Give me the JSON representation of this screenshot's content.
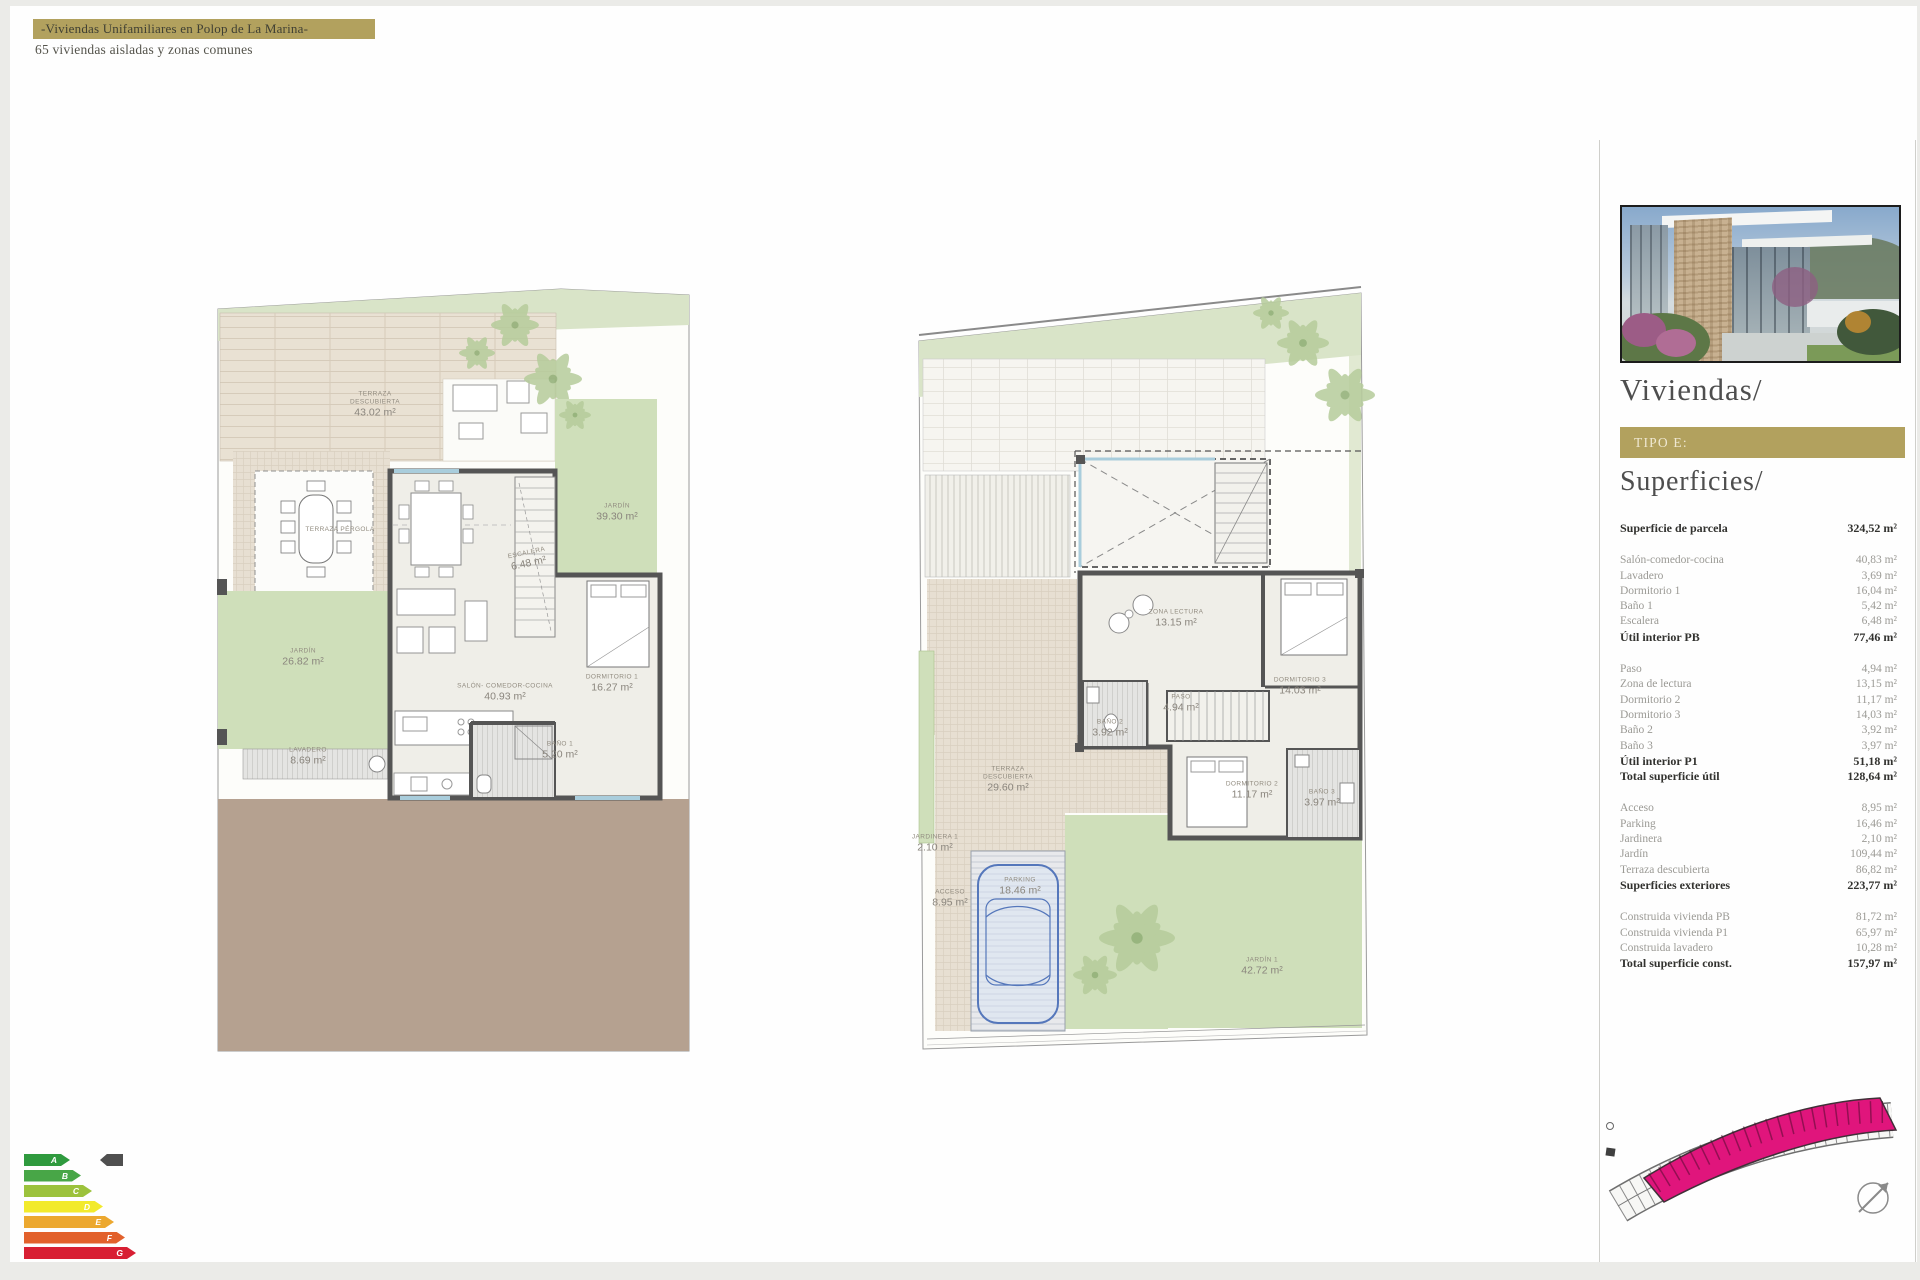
{
  "header": {
    "title": "-Viviendas Unifamiliares en Polop de La Marina-",
    "subtitle": "65 viviendas aisladas y zonas comunes"
  },
  "colors": {
    "gold": "#b2a15e",
    "siteplan_highlight": "#e0157c",
    "garden_green": "#cfdfba",
    "terrace_beige": "#e9e1d3",
    "soil_brown": "#b5a190"
  },
  "sidebar": {
    "title": "Viviendas/",
    "type_label": "TIPO E:",
    "section_title": "Superficies/",
    "photo_alt": "villa-exterior-render",
    "table": {
      "groups": [
        {
          "rows": [
            {
              "label": "Superficie de parcela",
              "value": "324,52 m²",
              "bold": true
            }
          ]
        },
        {
          "rows": [
            {
              "label": "Salón-comedor-cocina",
              "value": "40,83 m²",
              "bold": false
            },
            {
              "label": "Lavadero",
              "value": "3,69 m²",
              "bold": false
            },
            {
              "label": "Dormitorio 1",
              "value": "16,04 m²",
              "bold": false
            },
            {
              "label": "Baño 1",
              "value": "5,42 m²",
              "bold": false
            },
            {
              "label": "Escalera",
              "value": "6,48 m²",
              "bold": false
            },
            {
              "label": "Útil interior PB",
              "value": "77,46 m²",
              "bold": true
            }
          ]
        },
        {
          "rows": [
            {
              "label": "Paso",
              "value": "4,94 m²",
              "bold": false
            },
            {
              "label": "Zona de lectura",
              "value": "13,15 m²",
              "bold": false
            },
            {
              "label": "Dormitorio 2",
              "value": "11,17 m²",
              "bold": false
            },
            {
              "label": "Dormitorio 3",
              "value": "14,03 m²",
              "bold": false
            },
            {
              "label": "Baño 2",
              "value": "3,92 m²",
              "bold": false
            },
            {
              "label": "Baño 3",
              "value": "3,97 m²",
              "bold": false
            },
            {
              "label": "Útil interior P1",
              "value": "51,18 m²",
              "bold": true
            },
            {
              "label": "Total superficie útil",
              "value": "128,64 m²",
              "bold": true
            }
          ]
        },
        {
          "rows": [
            {
              "label": "Acceso",
              "value": "8,95 m²",
              "bold": false
            },
            {
              "label": "Parking",
              "value": "16,46 m²",
              "bold": false
            },
            {
              "label": "Jardinera",
              "value": "2,10 m²",
              "bold": false
            },
            {
              "label": "Jardín",
              "value": "109,44 m²",
              "bold": false
            },
            {
              "label": "Terraza descubierta",
              "value": "86,82 m²",
              "bold": false
            },
            {
              "label": "Superficies exteriores",
              "value": "223,77 m²",
              "bold": true
            }
          ]
        },
        {
          "rows": [
            {
              "label": "Construida vivienda PB",
              "value": "81,72 m²",
              "bold": false
            },
            {
              "label": "Construida vivienda P1",
              "value": "65,97 m²",
              "bold": false
            },
            {
              "label": "Construida lavadero",
              "value": "10,28 m²",
              "bold": false
            },
            {
              "label": "Total superficie const.",
              "value": "157,97 m²",
              "bold": true
            }
          ]
        }
      ]
    }
  },
  "plans": {
    "left": {
      "terraza": {
        "l1": "TERRAZA",
        "l2": "DESCUBIERTA",
        "a": "43.02 m²"
      },
      "pergola": {
        "l1": "TERRAZA PÉRGOLA",
        "a": ""
      },
      "jardin_dcha": {
        "l1": "JARDÍN",
        "a": "39.30 m²"
      },
      "jardin_izq": {
        "l1": "JARDÍN",
        "a": "26.82 m²"
      },
      "lavadero": {
        "l1": "LAVADERO",
        "a": "8.69 m²"
      },
      "escalera": {
        "l1": "ESCALERA",
        "a": "6.48 m²"
      },
      "salon": {
        "l1": "SALÓN- COMEDOR-COCINA",
        "a": "40.93 m²"
      },
      "dorm1": {
        "l1": "DORMITORIO 1",
        "a": "16.27 m²"
      },
      "bano1": {
        "l1": "BAÑO 1",
        "a": "5.20 m²"
      }
    },
    "right": {
      "zona": {
        "l1": "ZONA LECTURA",
        "a": "13.15 m²"
      },
      "paso": {
        "l1": "PASO",
        "a": "4.94 m²"
      },
      "dorm3": {
        "l1": "DORMITORIO 3",
        "a": "14.03 m²"
      },
      "bano2": {
        "l1": "BAÑO 2",
        "a": "3.92 m²"
      },
      "dorm2": {
        "l1": "DORMITORIO 2",
        "a": "11.17 m²"
      },
      "bano3": {
        "l1": "BAÑO 3",
        "a": "3.97 m²"
      },
      "terraza": {
        "l1": "TERRAZA",
        "l2": "DESCUBIERTA",
        "a": "29.60 m²"
      },
      "jardinera": {
        "l1": "JARDINERA 1",
        "a": "2.10 m²"
      },
      "acceso": {
        "l1": "ACCESO",
        "a": "8.95 m²"
      },
      "parking": {
        "l1": "PARKING",
        "a": "18.46 m²"
      },
      "jardin1": {
        "l1": "JARDÍN 1",
        "a": "42.72 m²"
      }
    }
  },
  "energy": {
    "grades": [
      {
        "letter": "A",
        "color": "#2f9a3e"
      },
      {
        "letter": "B",
        "color": "#48a647"
      },
      {
        "letter": "C",
        "color": "#9cc23c"
      },
      {
        "letter": "D",
        "color": "#f2ea2c"
      },
      {
        "letter": "E",
        "color": "#eca82f"
      },
      {
        "letter": "F",
        "color": "#e2612c"
      },
      {
        "letter": "G",
        "color": "#d81f33"
      }
    ],
    "marker_color": "#4f4f4f"
  }
}
